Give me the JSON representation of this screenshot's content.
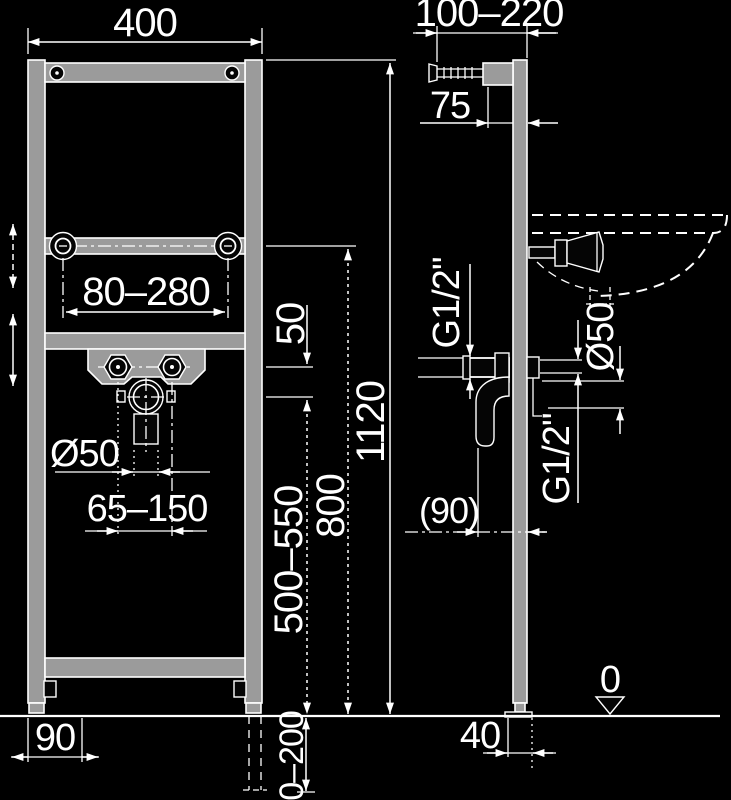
{
  "colors": {
    "background": "#000000",
    "line": "#ffffff",
    "steel_fill": "#9b9b9b",
    "part_fill": "#050505"
  },
  "front_view": {
    "frame_width": "400",
    "rod_spacing": "80–280",
    "faucet_to_drain_gap": "50",
    "drain_diameter": "Ø50",
    "drain_spacing": "65–150",
    "drain_height_range": "500–550",
    "rod_height": "800",
    "frame_height": "1120",
    "below_floor_range": "0–200",
    "foot_offset": "90"
  },
  "side_view": {
    "wall_distance_range": "100–220",
    "bracket_offset": "75",
    "water_thread_left": "G1/2\"",
    "drain_pipe_diameter": "Ø50",
    "water_thread_right": "G1/2\"",
    "trap_offset": "(90)",
    "floor_level": "0",
    "profile_depth": "40"
  }
}
